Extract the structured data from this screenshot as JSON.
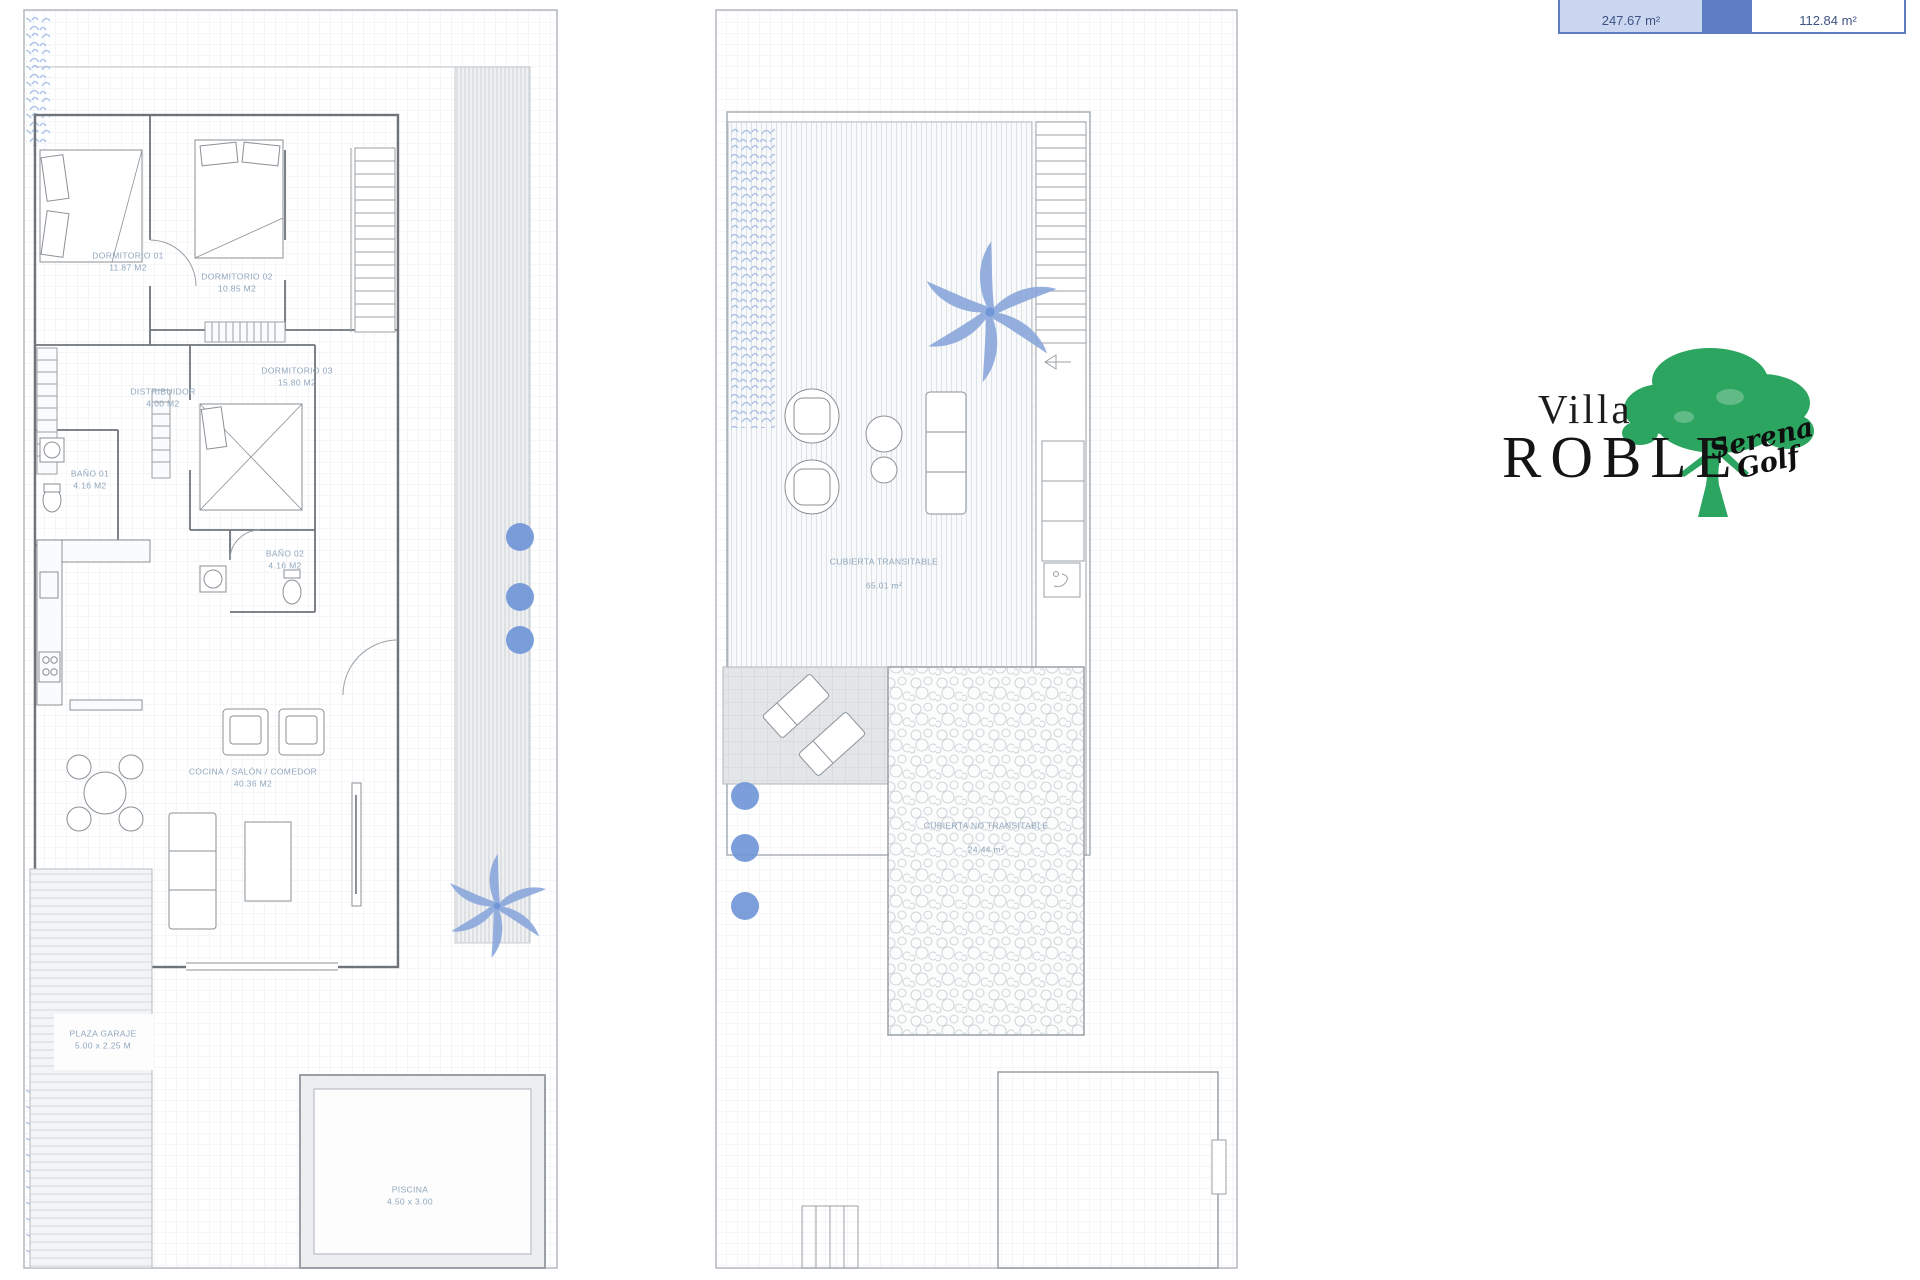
{
  "area_table": {
    "cells": [
      {
        "value": "247.67 m²"
      },
      {
        "value": "112.84 m²"
      }
    ],
    "border_color": "#5f7dc3",
    "fill_color": "#cbd7f1",
    "text_color": "#3f5384"
  },
  "logo": {
    "line1": "Villa",
    "line2": "ROBLE",
    "script_line1": "Serena",
    "script_line2": "Golf",
    "tree_color": "#2ba55f"
  },
  "floor1": {
    "name": "ground-floor-plan",
    "rooms": [
      {
        "name": "DORMITORIO 01",
        "area": "11.87 M2"
      },
      {
        "name": "DORMITORIO 02",
        "area": "10.85 M2"
      },
      {
        "name": "DORMITORIO 03",
        "area": "15.80 M2"
      },
      {
        "name": "DISTRIBUIDOR",
        "area": "4.00 M2"
      },
      {
        "name": "BAÑO 01",
        "area": "4.16 M2"
      },
      {
        "name": "BAÑO 02",
        "area": "4.16 M2"
      },
      {
        "name": "COCINA / SALÓN / COMEDOR",
        "area": "40.36 M2"
      },
      {
        "name": "PLAZA GARAJE",
        "area": "5.00 x 2.25 M"
      },
      {
        "name": "PISCINA",
        "area": "4.50 x 3.00"
      }
    ]
  },
  "floor2": {
    "name": "roof-terrace-plan",
    "rooms": [
      {
        "name": "CUBIERTA TRANSITABLE",
        "area": "65.01 m²"
      },
      {
        "name": "CUBIERTA NO TRANSITABLE",
        "area": "24.44 m²"
      }
    ]
  },
  "accents": {
    "plant_blue": "#7197d8",
    "leaf_blue": "#9db8e2",
    "label_blue_grey": "#8fa6bd"
  }
}
